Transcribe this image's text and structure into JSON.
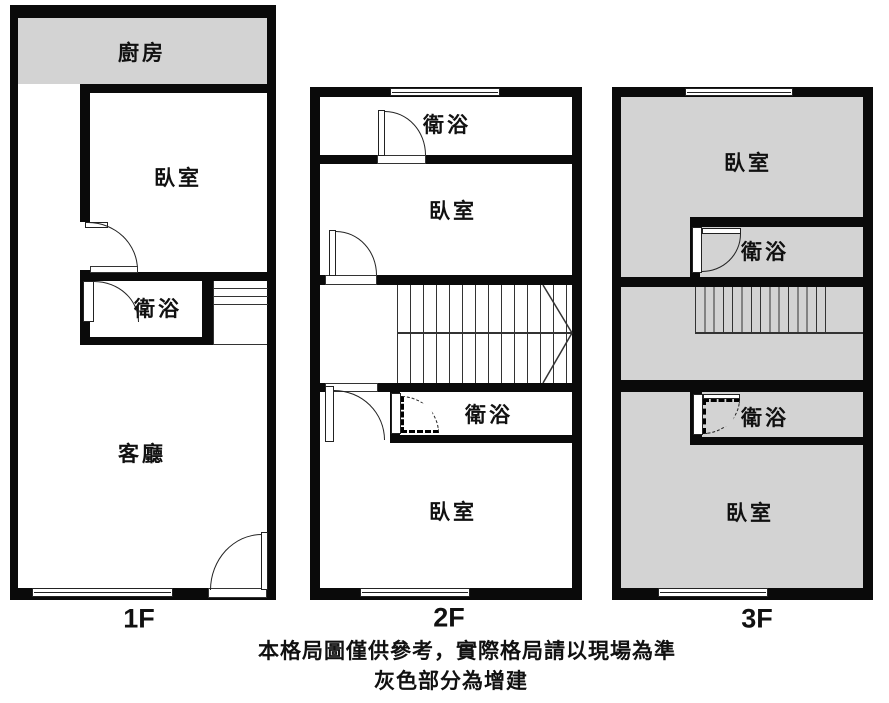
{
  "title": "三層樓住宅格局圖",
  "colors": {
    "wall": "#0a0a0a",
    "gray": "#d3d3d3",
    "ink": "#111111",
    "background": "#ffffff"
  },
  "caption": {
    "line1": "本格局圖僅供參考，實際格局請以現場為準",
    "line2": "灰色部分為增建"
  },
  "floors": [
    {
      "id": "1f",
      "label": "1F",
      "rooms": [
        {
          "name": "kitchen",
          "label": "廚房",
          "addition": true
        },
        {
          "name": "bedroom",
          "label": "臥室",
          "addition": false
        },
        {
          "name": "bathroom",
          "label": "衛浴",
          "addition": false
        },
        {
          "name": "living-room",
          "label": "客廳",
          "addition": false
        }
      ]
    },
    {
      "id": "2f",
      "label": "2F",
      "rooms": [
        {
          "name": "bathroom-top",
          "label": "衛浴",
          "addition": false
        },
        {
          "name": "bedroom-top",
          "label": "臥室",
          "addition": false
        },
        {
          "name": "bathroom-bottom",
          "label": "衛浴",
          "addition": false
        },
        {
          "name": "bedroom-bottom",
          "label": "臥室",
          "addition": false
        }
      ]
    },
    {
      "id": "3f",
      "label": "3F",
      "rooms": [
        {
          "name": "bedroom-top",
          "label": "臥室",
          "addition": true
        },
        {
          "name": "bathroom-top",
          "label": "衛浴",
          "addition": true
        },
        {
          "name": "bathroom-bottom",
          "label": "衛浴",
          "addition": true
        },
        {
          "name": "bedroom-bottom",
          "label": "臥室",
          "addition": true
        }
      ]
    }
  ]
}
